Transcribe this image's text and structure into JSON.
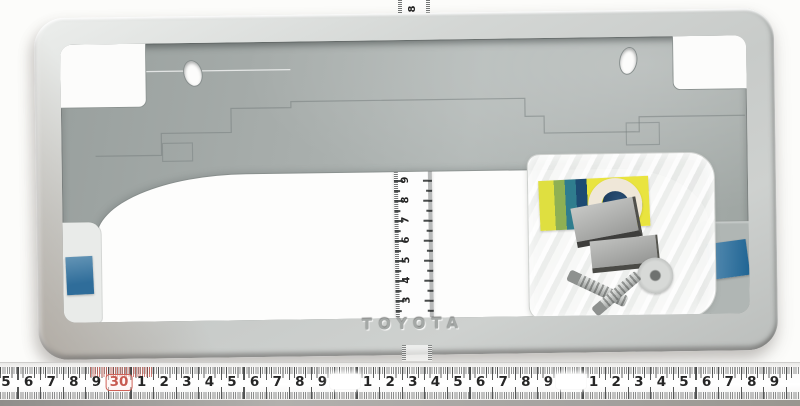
{
  "scene": {
    "type": "product-photo",
    "background_color": "#fcfcfa",
    "subject": "silver-license-plate-frame-with-rulers-and-hardware-bag"
  },
  "frame": {
    "brand_label": "TOYOTA",
    "face_color": "#cdd0ce",
    "plate_color": "#a8aeac",
    "tape_color": "#2f6d9a"
  },
  "vertical_ruler": {
    "top_label": "8",
    "labels": [
      "9",
      "8",
      "7",
      "6",
      "5",
      "4",
      "3"
    ]
  },
  "bottom_ruler": {
    "number_color": "#262626",
    "highlight_color": "#c75a50",
    "cells": [
      {
        "text": "5"
      },
      {
        "text": "6"
      },
      {
        "text": "7"
      },
      {
        "text": "8"
      },
      {
        "text": "9"
      },
      {
        "text": "30",
        "type": "highlight"
      },
      {
        "text": "1"
      },
      {
        "text": "2"
      },
      {
        "text": "3"
      },
      {
        "text": "4"
      },
      {
        "text": "5"
      },
      {
        "text": "6"
      },
      {
        "text": "7"
      },
      {
        "text": "8"
      },
      {
        "text": "9"
      },
      {
        "text": "",
        "type": "washed"
      },
      {
        "text": "1"
      },
      {
        "text": "2"
      },
      {
        "text": "3"
      },
      {
        "text": "4"
      },
      {
        "text": "5"
      },
      {
        "text": "6"
      },
      {
        "text": "7"
      },
      {
        "text": "8"
      },
      {
        "text": "9"
      },
      {
        "text": "",
        "type": "washed"
      },
      {
        "text": "1"
      },
      {
        "text": "2"
      },
      {
        "text": "3"
      },
      {
        "text": "4"
      },
      {
        "text": "5"
      },
      {
        "text": "6"
      },
      {
        "text": "7"
      },
      {
        "text": "8"
      },
      {
        "text": "9"
      }
    ]
  },
  "hardware_bag": {
    "contents": [
      "adhesive-pad",
      "foam-ring",
      "spacer-block",
      "spacer-block",
      "metal-washer",
      "screw",
      "screw"
    ],
    "pad_color": "#e8e23e"
  }
}
